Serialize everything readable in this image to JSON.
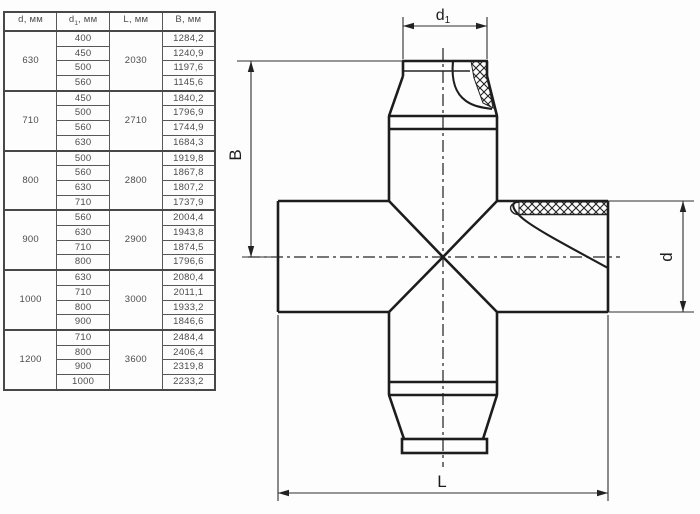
{
  "table": {
    "headers": [
      {
        "pre": "d",
        "sub": "",
        "post": ", мм"
      },
      {
        "pre": "d",
        "sub": "1",
        "post": ", мм"
      },
      {
        "pre": "L",
        "sub": "",
        "post": ", мм"
      },
      {
        "pre": "B",
        "sub": "",
        "post": ", мм"
      }
    ],
    "groups": [
      {
        "d": "630",
        "L": "2030",
        "rows": [
          {
            "d1": "400",
            "B": "1284,2"
          },
          {
            "d1": "450",
            "B": "1240,9"
          },
          {
            "d1": "500",
            "B": "1197,6"
          },
          {
            "d1": "560",
            "B": "1145,6"
          }
        ]
      },
      {
        "d": "710",
        "L": "2710",
        "rows": [
          {
            "d1": "450",
            "B": "1840,2"
          },
          {
            "d1": "500",
            "B": "1796,9"
          },
          {
            "d1": "560",
            "B": "1744,9"
          },
          {
            "d1": "630",
            "B": "1684,3"
          }
        ]
      },
      {
        "d": "800",
        "L": "2800",
        "rows": [
          {
            "d1": "500",
            "B": "1919,8"
          },
          {
            "d1": "560",
            "B": "1867,8"
          },
          {
            "d1": "630",
            "B": "1807,2"
          },
          {
            "d1": "710",
            "B": "1737,9"
          }
        ]
      },
      {
        "d": "900",
        "L": "2900",
        "rows": [
          {
            "d1": "560",
            "B": "2004,4"
          },
          {
            "d1": "630",
            "B": "1943,8"
          },
          {
            "d1": "710",
            "B": "1874,5"
          },
          {
            "d1": "800",
            "B": "1796,6"
          }
        ]
      },
      {
        "d": "1000",
        "L": "3000",
        "rows": [
          {
            "d1": "630",
            "B": "2080,4"
          },
          {
            "d1": "710",
            "B": "2011,1"
          },
          {
            "d1": "800",
            "B": "1933,2"
          },
          {
            "d1": "900",
            "B": "1846,6"
          }
        ]
      },
      {
        "d": "1200",
        "L": "3600",
        "rows": [
          {
            "d1": "710",
            "B": "2484,4"
          },
          {
            "d1": "800",
            "B": "2406,4"
          },
          {
            "d1": "900",
            "B": "2319,8"
          },
          {
            "d1": "1000",
            "B": "2233,2"
          }
        ]
      }
    ]
  },
  "drawing": {
    "labels": {
      "top_diameter_pre": "d",
      "top_diameter_sub": "1",
      "height": "B",
      "side_diameter": "d",
      "length": "L"
    },
    "colors": {
      "outline": "#1d1d1d",
      "dimension": "#2e2e2e"
    }
  }
}
